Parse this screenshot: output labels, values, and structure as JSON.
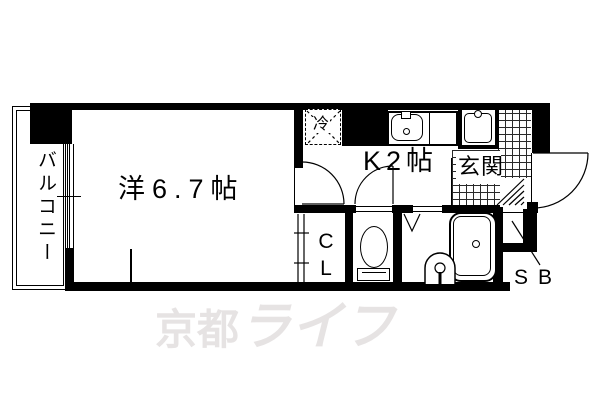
{
  "title": "apartment-floorplan",
  "watermark": {
    "part1": "京都",
    "part2": "ライフ"
  },
  "labels": {
    "balcony": "バルコニー",
    "western_room": "洋6.7帖",
    "kitchen": "K2帖",
    "entrance": "玄関",
    "closet_c": "C",
    "closet_l": "L",
    "shoe_box": "SB",
    "refrigerator": "冷"
  },
  "colors": {
    "wall": "#000000",
    "watermark": "#e6e3e3",
    "tile_line": "#2a2a2a",
    "background": "#ffffff"
  }
}
